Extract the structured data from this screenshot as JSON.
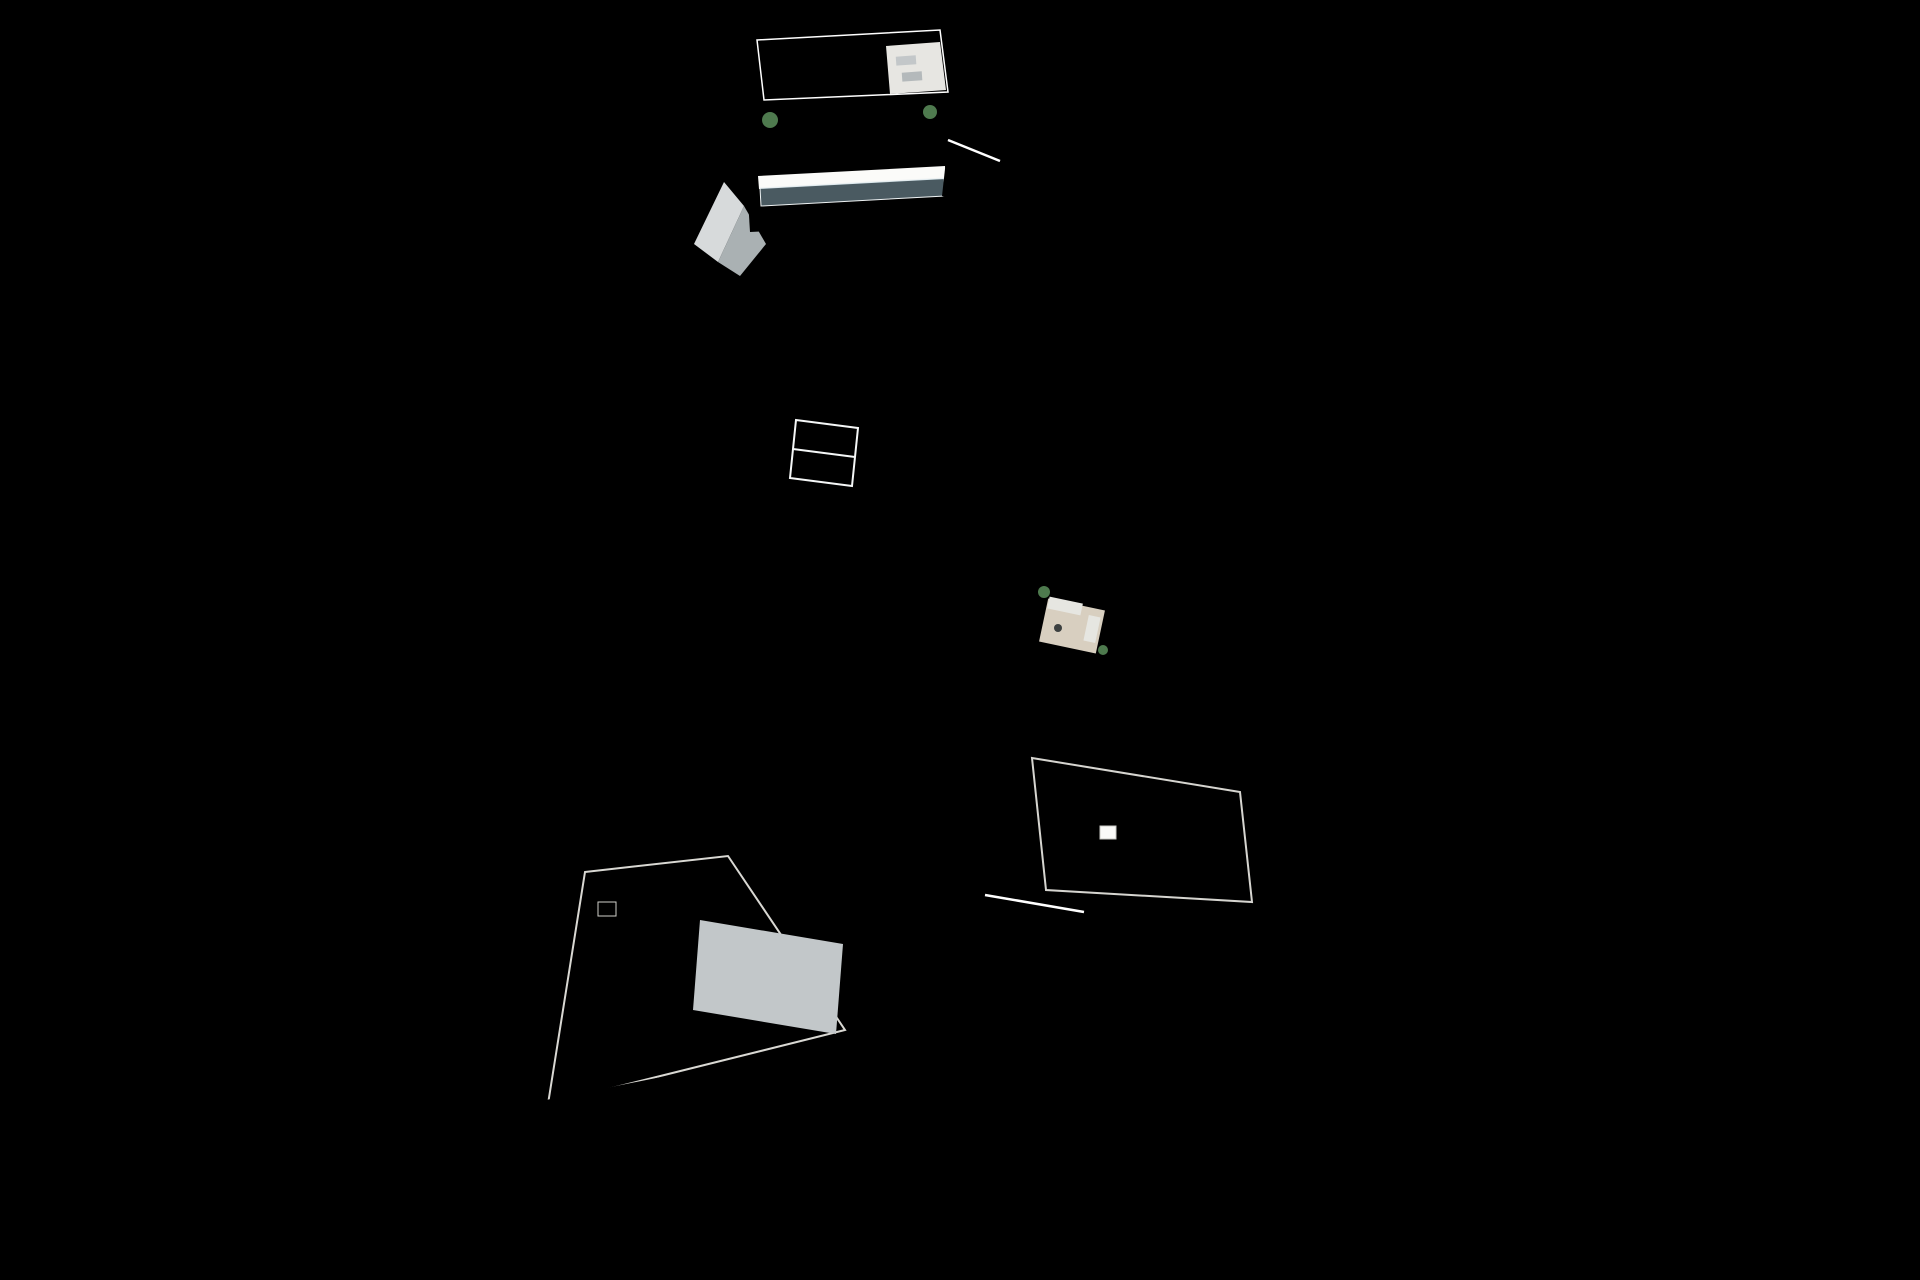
{
  "scene": {
    "type": "architectural-3d-aerial-render",
    "description": "Aerial 3D visualization of a new-build residential development: a long fenced plot with a row of white townhouses with roof terraces on the right, a central dark pergola walkway, a communal garden with main pool, kids pool, glass pavilion, shade sails, sun loungers and palm trees on the left, a detached villa with white slatted pergola at the bottom, and a paved driveway entrance at the bottom right.",
    "elements": {
      "townhouse_units": 11,
      "detached_villas": 2,
      "pools": 2,
      "palm_trees": 10,
      "shade_sails": 3,
      "sun_loungers": 10,
      "gazebo": 1,
      "glass_pavilion": 1
    }
  },
  "colors": {
    "background": "#d8dfe1",
    "lawn": "#3a8f2f",
    "lawn_bright": "#42a336",
    "lawn_shadow": "#1c4f1d",
    "backyard": "#1d4a1c",
    "hedge": "#2a5629",
    "hedge2": "#336230",
    "sand": "#e6c077",
    "sand_shade": "#c9a258",
    "deck": "#e9e8e3",
    "pool": "#64808f",
    "pool_light": "#a9c3cc",
    "kids_pool": "#8fb9c9",
    "kids_pool_light": "#cfe3e8",
    "roof_a": "#f1f0ec",
    "roof_b": "#eae9e4",
    "roof_base": "#edebe6",
    "roof_edge": "#d6d5d0",
    "wall_sun": "#f5f4f1",
    "wall_shade": "#ccd0d2",
    "glazing": "#45525a",
    "walkway": "#53585c",
    "walkway_dark": "#33373a",
    "walkway_light": "#7a7f83",
    "entry_deck": "#d8d8d3",
    "wood": "#a3805c",
    "wood_dark": "#7d5f42",
    "glass": "#b9d1d8",
    "fence": "#f2f3f3",
    "fence_post": "#84909a",
    "white": "#ffffff",
    "shadow": "rgba(20,35,18,0.28)",
    "palm1": "#6c8c6b",
    "palm2": "#53775a",
    "palm3": "#85a383",
    "trunk": "#9b8a70",
    "lounger": "#f4f1ea",
    "lounger_dark": "#3c4040",
    "stair": "#dedfdb",
    "stair_step": "#b9b9b4",
    "driveway": "#c9cdd0",
    "driveway_shadow": "#93a5b4",
    "window": "#33424a"
  },
  "geometry": {
    "plot": [
      [
        640,
        97
      ],
      [
        1118,
        80
      ],
      [
        1368,
        1188
      ],
      [
        1290,
        1236
      ],
      [
        845,
        1252
      ],
      [
        455,
        1190
      ]
    ],
    "garden_overlay": [
      [
        652,
        130
      ],
      [
        780,
        163
      ],
      [
        886,
        332
      ],
      [
        900,
        545
      ],
      [
        868,
        812
      ],
      [
        540,
        838
      ],
      [
        510,
        925
      ]
    ],
    "bottom_lawn": [
      [
        852,
        972
      ],
      [
        1206,
        1056
      ],
      [
        1186,
        1228
      ],
      [
        848,
        1248
      ]
    ],
    "building_shadow_lawn": [
      [
        878,
        958
      ],
      [
        1012,
        968
      ],
      [
        1020,
        1092
      ],
      [
        888,
        1096
      ]
    ],
    "villa_shadow_lawn": [
      [
        552,
        1172
      ],
      [
        850,
        1104
      ],
      [
        856,
        1130
      ],
      [
        558,
        1200
      ]
    ],
    "backyard_strip": [
      [
        1124,
        100
      ],
      [
        1160,
        92
      ],
      [
        1366,
        1182
      ],
      [
        1240,
        1124
      ]
    ],
    "sand_main": [
      [
        758,
        162
      ],
      [
        800,
        240
      ],
      [
        878,
        330
      ],
      [
        895,
        480
      ],
      [
        893,
        560
      ],
      [
        872,
        660
      ],
      [
        861,
        780
      ],
      [
        861,
        900
      ],
      [
        886,
        975
      ]
    ],
    "sand_cross": [
      [
        540,
        822
      ],
      [
        880,
        806
      ]
    ],
    "sand_top": [
      [
        688,
        138
      ],
      [
        758,
        162
      ]
    ],
    "walkway": {
      "WL": [
        [
          958,
          58
        ],
        [
          996,
          1002
        ]
      ],
      "WR": [
        [
          1006,
          56
        ],
        [
          1046,
          998
        ]
      ],
      "slats": 44
    },
    "entry_deck": [
      [
        1006,
        56
      ],
      [
        1016,
        76
      ],
      [
        1064,
        984
      ],
      [
        1046,
        998
      ]
    ],
    "roofs": {
      "A": [
        [
          1016,
          76
        ],
        [
          1064,
          984
        ]
      ],
      "B": [
        [
          1126,
          108
        ],
        [
          1230,
          1118
        ]
      ],
      "F": [
        [
          1126,
          96
        ],
        [
          1360,
          1176
        ]
      ],
      "units": 11,
      "skylights": [
        1,
        5,
        8
      ]
    },
    "hedge": {
      "line": [
        [
          650,
          130
        ],
        [
          512,
          920
        ]
      ],
      "count": 24
    },
    "fences": {
      "left": {
        "line": [
          [
            640,
            97
          ],
          [
            455,
            1190
          ]
        ],
        "step": 30
      },
      "right": {
        "line": [
          [
            1118,
            80
          ],
          [
            1368,
            1188
          ]
        ],
        "step": 32
      },
      "bottom": {
        "line": [
          [
            455,
            1190
          ],
          [
            845,
            1252
          ],
          [
            1290,
            1236
          ],
          [
            1368,
            1188
          ]
        ],
        "step": 26
      },
      "top": {
        "line": [
          [
            640,
            97
          ],
          [
            1118,
            80
          ]
        ],
        "step": 40
      }
    },
    "palms": [
      {
        "x": 553,
        "y": 215,
        "s": 1.25
      },
      {
        "x": 845,
        "y": 120,
        "s": 1.0
      },
      {
        "x": 648,
        "y": 232,
        "s": 0.85
      },
      {
        "x": 568,
        "y": 478,
        "s": 1.3
      },
      {
        "x": 528,
        "y": 640,
        "s": 1.35
      },
      {
        "x": 735,
        "y": 645,
        "s": 1.0
      },
      {
        "x": 695,
        "y": 688,
        "s": 0.9
      },
      {
        "x": 838,
        "y": 420,
        "s": 1.05
      },
      {
        "x": 737,
        "y": 300,
        "s": 0.55
      },
      {
        "x": 618,
        "y": 742,
        "s": 0.8
      }
    ],
    "shrubs": [
      {
        "x": 700,
        "y": 312,
        "r": 16
      },
      {
        "x": 672,
        "y": 352,
        "r": 11
      },
      {
        "x": 760,
        "y": 205,
        "r": 12
      },
      {
        "x": 640,
        "y": 175,
        "r": 10
      },
      {
        "x": 905,
        "y": 208,
        "r": 9
      },
      {
        "x": 560,
        "y": 560,
        "r": 9
      }
    ],
    "sails": [
      {
        "x": 668,
        "y": 306
      },
      {
        "x": 676,
        "y": 368
      },
      {
        "x": 660,
        "y": 414
      }
    ],
    "loungers_top": {
      "start": [
        664,
        512
      ],
      "step": [
        32,
        -6
      ],
      "count": 5
    },
    "loungers_bottom": {
      "start": [
        606,
        795
      ],
      "step": [
        39,
        -9
      ],
      "count": 5
    },
    "planters": [
      [
        652,
        532
      ],
      [
        643,
        588
      ],
      [
        637,
        644
      ],
      [
        648,
        700
      ]
    ],
    "bollards": [
      [
        800,
        212
      ],
      [
        840,
        268
      ],
      [
        876,
        330
      ],
      [
        892,
        420
      ],
      [
        897,
        515
      ],
      [
        886,
        612
      ],
      [
        870,
        705
      ],
      [
        862,
        800
      ],
      [
        858,
        892
      ],
      [
        880,
        962
      ]
    ],
    "slatted": [
      {
        "name": "villa-roof-pergola",
        "quad": [
          [
            700,
            920
          ],
          [
            843,
            944
          ],
          [
            836,
            1034
          ],
          [
            693,
            1010
          ]
        ],
        "n": 13,
        "stroke": "white",
        "w": 3
      },
      {
        "name": "townhouse-roof-pergola",
        "quad": [
          [
            1074,
            478
          ],
          [
            1130,
            492
          ],
          [
            1118,
            548
          ],
          [
            1062,
            534
          ]
        ],
        "n": 7,
        "stroke": "wood_dark",
        "w": 2
      },
      {
        "name": "glass-pavilion-mullions",
        "quad": [
          [
            796,
            420
          ],
          [
            858,
            428
          ],
          [
            852,
            486
          ],
          [
            790,
            478
          ]
        ],
        "n": 4,
        "stroke": "white",
        "w": 1.5
      },
      {
        "name": "top-building-stair-steps",
        "quad": [
          [
            948,
            142
          ],
          [
            998,
            162
          ],
          [
            991,
            212
          ],
          [
            942,
            196
          ]
        ],
        "n": 6,
        "stroke": "stair_step",
        "w": 1.5
      },
      {
        "name": "bottom-building-stair-steps",
        "quad": [
          [
            986,
            898
          ],
          [
            1082,
            914
          ],
          [
            1076,
            948
          ],
          [
            980,
            932
          ]
        ],
        "n": 7,
        "stroke": "stair_step",
        "w": 1.5
      },
      {
        "name": "top-building-roof-glazing-mullions",
        "quad": [
          [
            780,
            52
          ],
          [
            880,
            46
          ],
          [
            884,
            88
          ],
          [
            784,
            94
          ]
        ],
        "n": 6,
        "stroke": "walkway_light",
        "w": 1
      },
      {
        "name": "top-building-facade-glazing-mullions",
        "quad": [
          [
            770,
            128
          ],
          [
            935,
            118
          ],
          [
            937,
            164
          ],
          [
            772,
            174
          ]
        ],
        "n": 10,
        "stroke": "walkway_light",
        "w": 1
      }
    ],
    "villa_windows": {
      "a": [
        552,
        1140
      ],
      "b": [
        848,
        1078
      ],
      "ts": [
        0.06,
        0.25,
        0.45,
        0.64,
        0.83
      ],
      "w": 30,
      "h": 24,
      "rot": -11
    },
    "beams_south": [
      [
        [
          798,
          884
        ],
        [
          960,
          910
        ]
      ],
      [
        [
          802,
          902
        ],
        [
          964,
          928
        ]
      ],
      [
        [
          806,
          920
        ],
        [
          968,
          946
        ]
      ],
      [
        [
          810,
          938
        ],
        [
          972,
          964
        ]
      ]
    ],
    "beams_villa": [
      [
        [
          548,
          836
        ],
        [
          620,
          828
        ]
      ],
      [
        [
          550,
          848
        ],
        [
          622,
          840
        ]
      ],
      [
        [
          552,
          860
        ],
        [
          624,
          852
        ]
      ]
    ]
  }
}
